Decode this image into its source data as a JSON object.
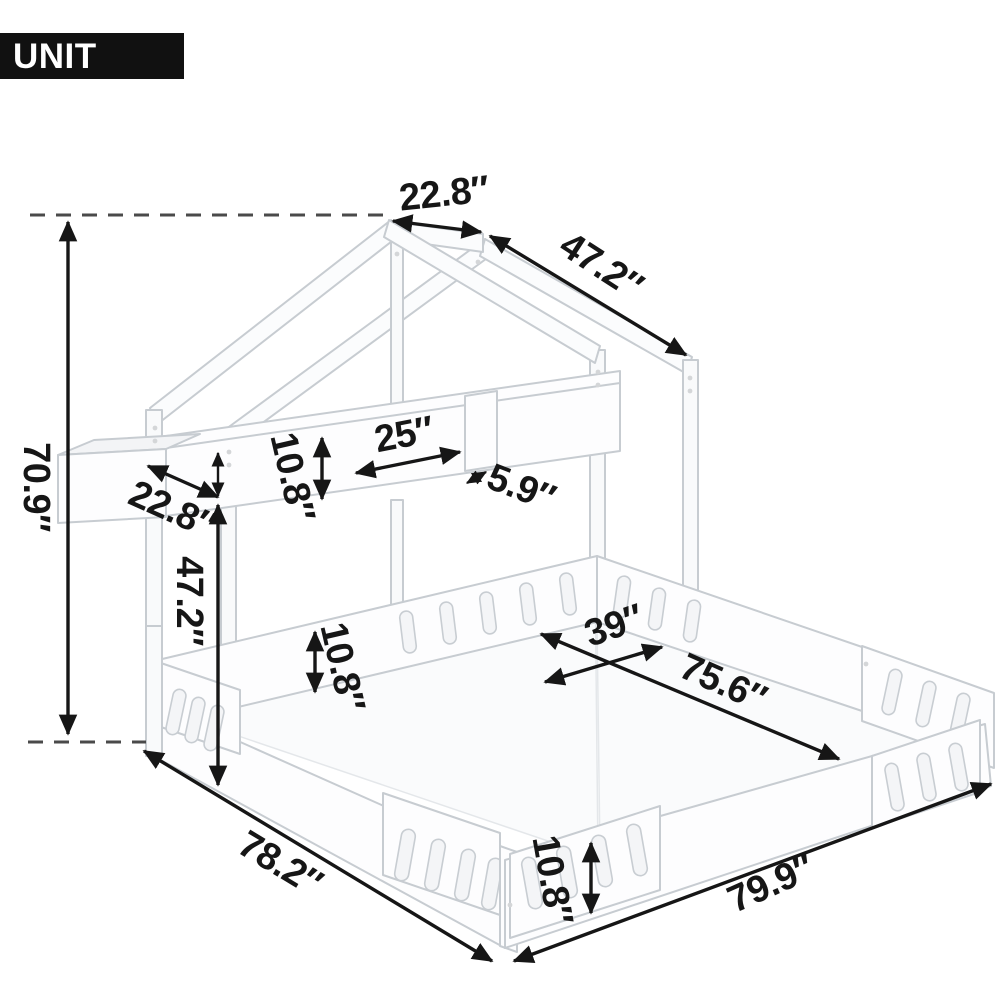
{
  "badge": {
    "label": "UNIT INCH"
  },
  "dims": {
    "total_height": "70.9″",
    "roof_ridge_depth": "22.8″",
    "roof_slope_length": "47.2″",
    "shelf_end_depth": "22.8″",
    "shelf_height": "10.8″",
    "shelf_section_length": "25″",
    "shelf_divider_width": "5.9″",
    "under_shelf_clearance": "47.2″",
    "mid_rail_height": "10.8″",
    "right_bed_width": "39″",
    "right_bed_inner_length": "75.6″",
    "left_bed_length": "78.2″",
    "front_rail_height": "10.8″",
    "right_bed_length": "79.9″"
  }
}
